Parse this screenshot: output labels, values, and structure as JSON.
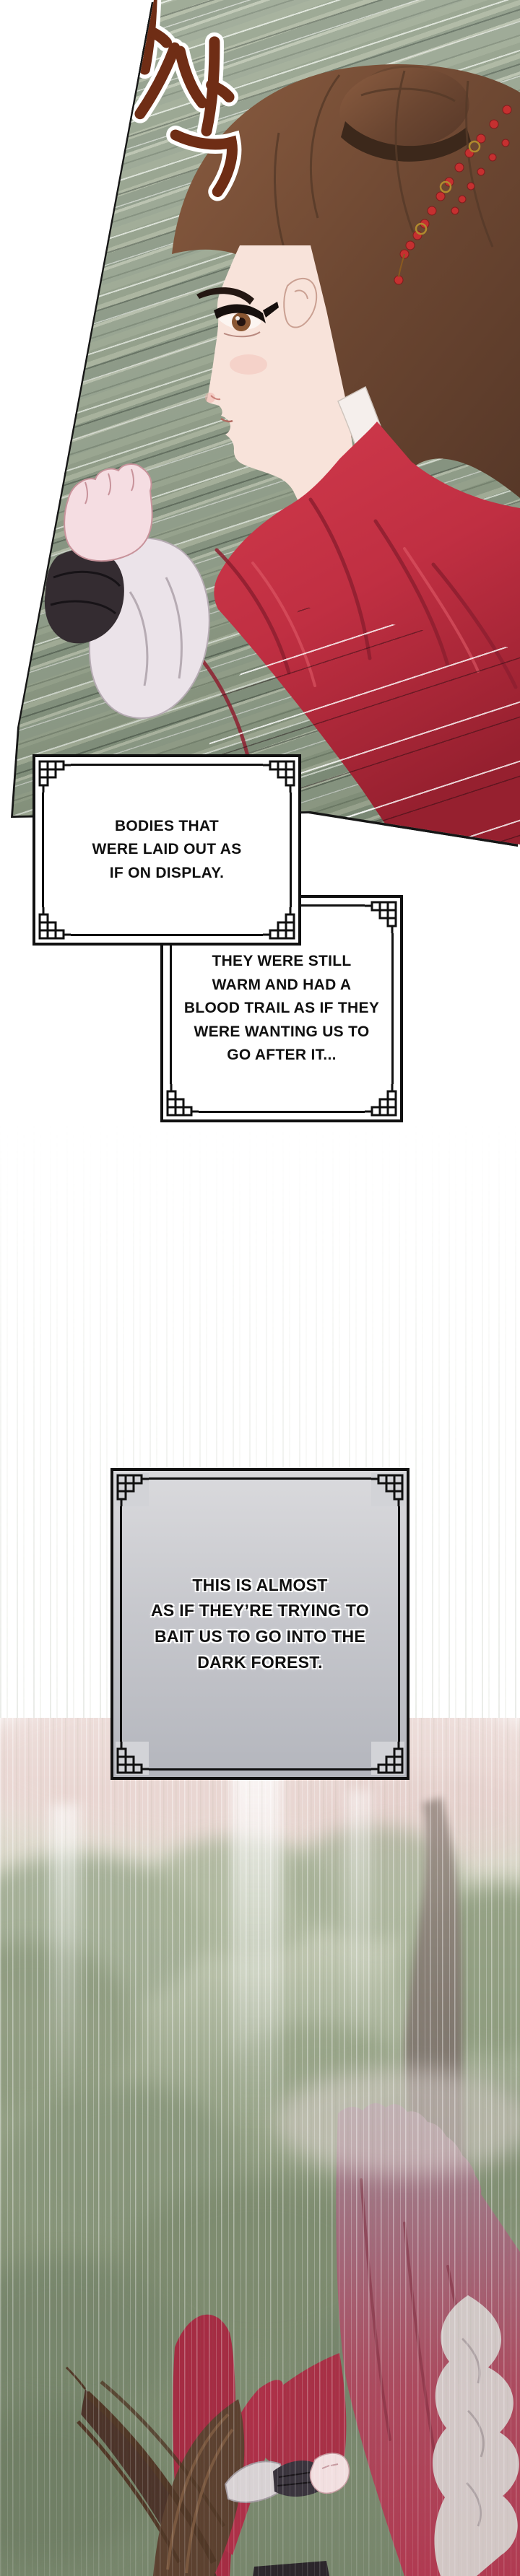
{
  "page": {
    "kind": "webtoon-comic-panel",
    "background": "#ffffff"
  },
  "sfx": {
    "text": "사삭",
    "color": "#6e2c14",
    "outline": "#ffffff"
  },
  "dialogues": [
    {
      "lines": [
        "BODIES THAT",
        "WERE LAID OUT AS",
        "IF ON DISPLAY."
      ]
    },
    {
      "lines": [
        "THEY WERE STILL",
        "WARM AND HAD A",
        "BLOOD TRAIL AS IF THEY",
        "WERE WANTING US TO",
        "GO AFTER IT..."
      ]
    },
    {
      "lines": [
        "THIS IS ALMOST",
        "AS IF THEY’RE TRYING TO",
        "BAIT US TO GO INTO THE",
        "DARK FOREST."
      ]
    }
  ],
  "palette": {
    "motion_streak_green": "#93a18b",
    "robe_red": "#c13043",
    "cape_red": "#b03a51",
    "hair_brown": "#6b4a35",
    "bead_red": "#c53030",
    "frame_black": "#101010",
    "box3_fill": "#c6c7cc",
    "forest_green": "#7d8b72",
    "mist_pink": "#e8d6d2"
  }
}
